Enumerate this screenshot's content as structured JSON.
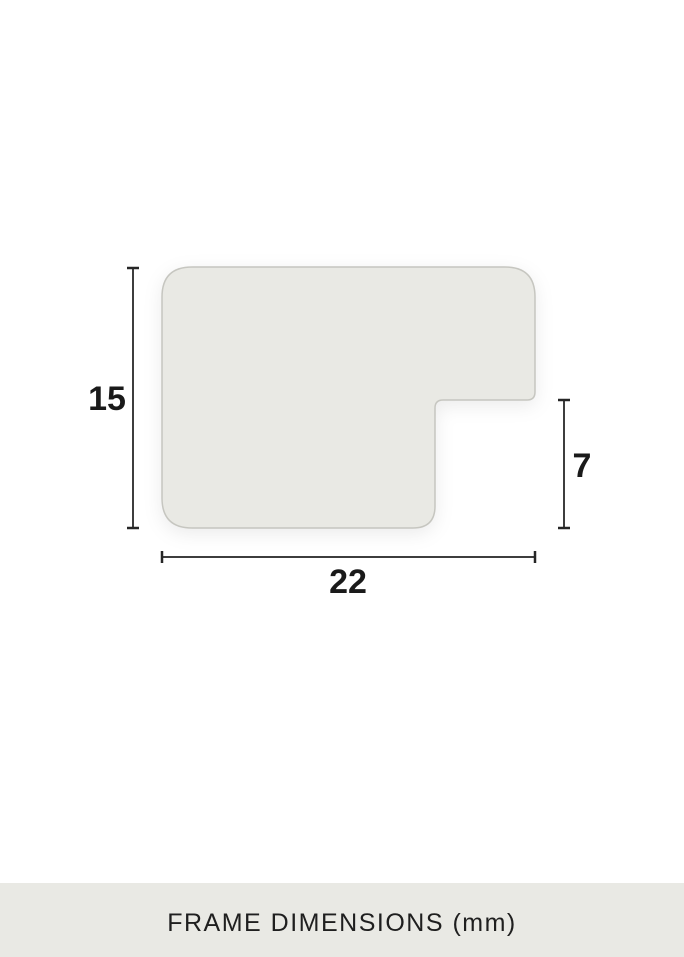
{
  "diagram": {
    "title": "frame-profile-cross-section",
    "dimensions": {
      "height_label": "15",
      "rabbet_height_label": "7",
      "width_label": "22"
    },
    "unit": "mm"
  },
  "footer": {
    "caption": "FRAME DIMENSIONS (mm)"
  },
  "colors": {
    "bg": "#ffffff",
    "shape-fill": "#e9e9e4",
    "shape-border": "#c6c6c0",
    "dim-line": "#3d3d3d",
    "label-text": "#1a1a1a",
    "footer-bg": "#e9e9e4",
    "footer-text": "#1f1f1f"
  }
}
